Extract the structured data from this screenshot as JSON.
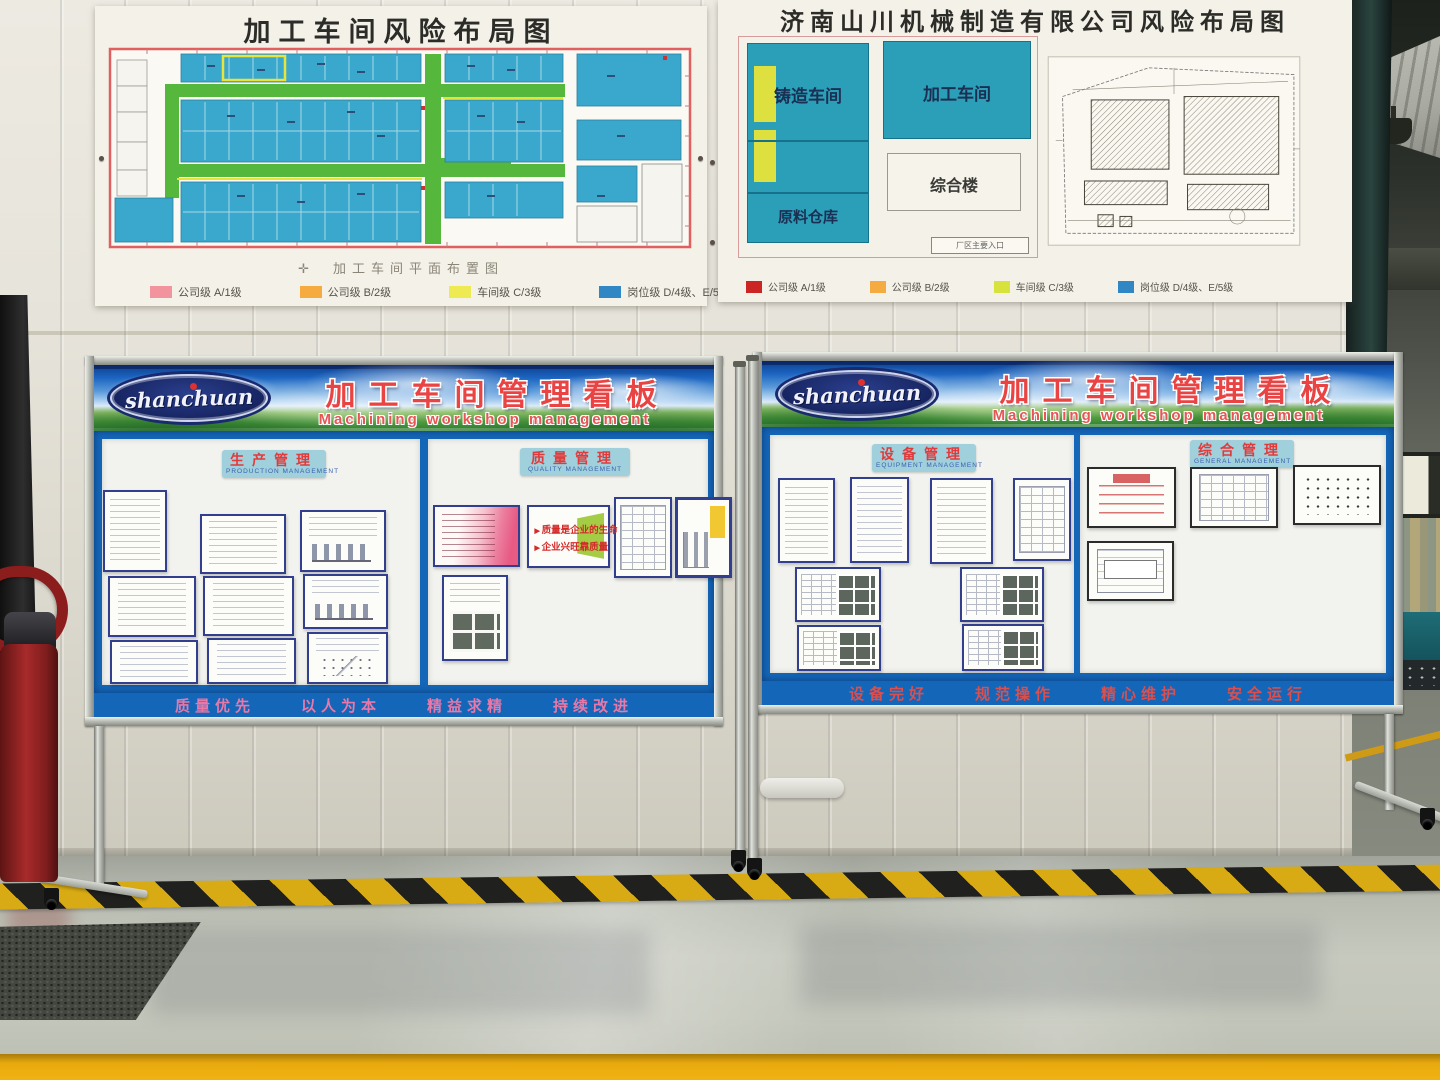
{
  "posters": {
    "left": {
      "title": "加工车间风险布局图",
      "caption": "加工车间平面布置图",
      "compass": "✛",
      "legend": [
        {
          "label": "公司级 A/1级",
          "color": "#f2949e"
        },
        {
          "label": "公司级 B/2级",
          "color": "#f5ab40"
        },
        {
          "label": "车间级 C/3级",
          "color": "#eeea52"
        },
        {
          "label": "岗位级 D/4级、E/5级",
          "color": "#3187c4"
        }
      ]
    },
    "right": {
      "title": "济南山川机械制造有限公司风险布局图",
      "zones": {
        "foundry": "铸造车间",
        "machining": "加工车间",
        "office": "综合楼",
        "warehouse": "原料仓库",
        "entrance": "厂区主要入口"
      },
      "legend": [
        {
          "label": "公司级 A/1级",
          "color": "#cc2525"
        },
        {
          "label": "公司级 B/2级",
          "color": "#f5ab40"
        },
        {
          "label": "车间级 C/3级",
          "color": "#d8e23c"
        },
        {
          "label": "岗位级 D/4级、E/5级",
          "color": "#3187c4"
        }
      ]
    }
  },
  "boards": {
    "left": {
      "logo_text": "shanchuan",
      "title": "加工车间管理看板",
      "subtitle": "Machining workshop management",
      "sections": [
        {
          "title": "生产管理",
          "subtitle": "PRODUCTION MANAGEMENT"
        },
        {
          "title": "质量管理",
          "subtitle": "QUALITY MANAGEMENT"
        }
      ],
      "quotes": [
        "质量是企业的生命",
        "企业兴旺靠质量"
      ],
      "slogan": [
        "质量优先",
        "以人为本",
        "精益求精",
        "持续改进"
      ]
    },
    "right": {
      "logo_text": "shanchuan",
      "title": "加工车间管理看板",
      "subtitle": "Machining workshop management",
      "sections": [
        {
          "title": "设备管理",
          "subtitle": "EQUIPMENT MANAGEMENT"
        },
        {
          "title": "综合管理",
          "subtitle": "GENERAL MANAGEMENT"
        }
      ],
      "slogan": [
        "设备完好",
        "规范操作",
        "精心维护",
        "安全运行"
      ]
    }
  },
  "colors": {
    "board_blue": "#1466b8",
    "plan_blue": "#3aa8cc",
    "aisle_green": "#55b83c",
    "hazard_yellow": "#d8ab14",
    "banner_red": "#ea4343"
  }
}
